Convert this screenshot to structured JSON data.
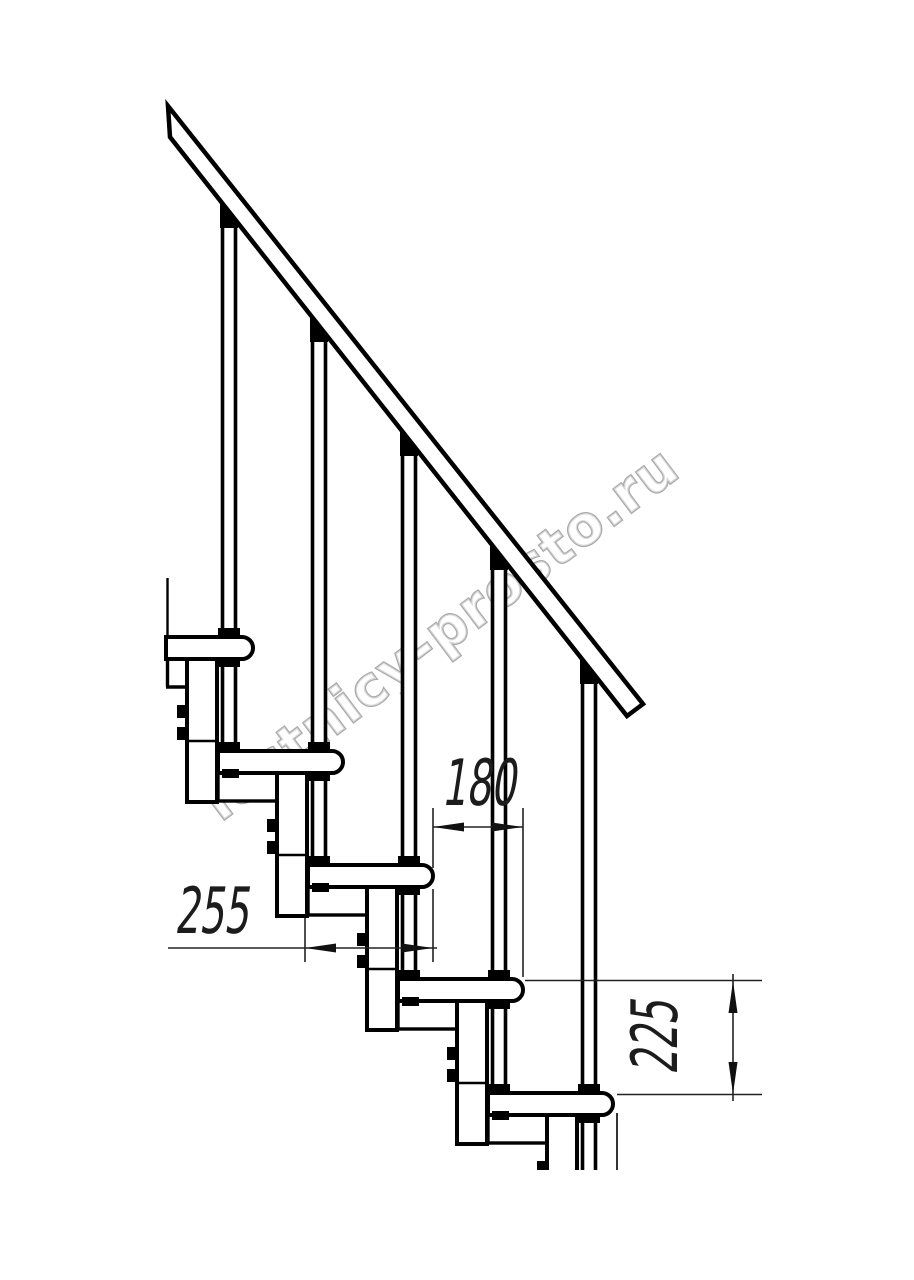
{
  "drawing": {
    "title": "modular staircase side elevation",
    "background_color": "#ffffff",
    "line_color": "#000000",
    "visible_treads": 5,
    "visible_balusters": 5,
    "handrail": "diagonal top-left to right"
  },
  "watermark": {
    "text": "lestnicy-prosto.ru",
    "outline_color": "#a9a9a9",
    "angle_deg": -37
  },
  "dimensions": {
    "tread_overlap": {
      "value": "180",
      "orientation": "horizontal"
    },
    "tread_depth": {
      "value": "255",
      "orientation": "horizontal"
    },
    "step_height": {
      "value": "225",
      "orientation": "vertical"
    }
  }
}
